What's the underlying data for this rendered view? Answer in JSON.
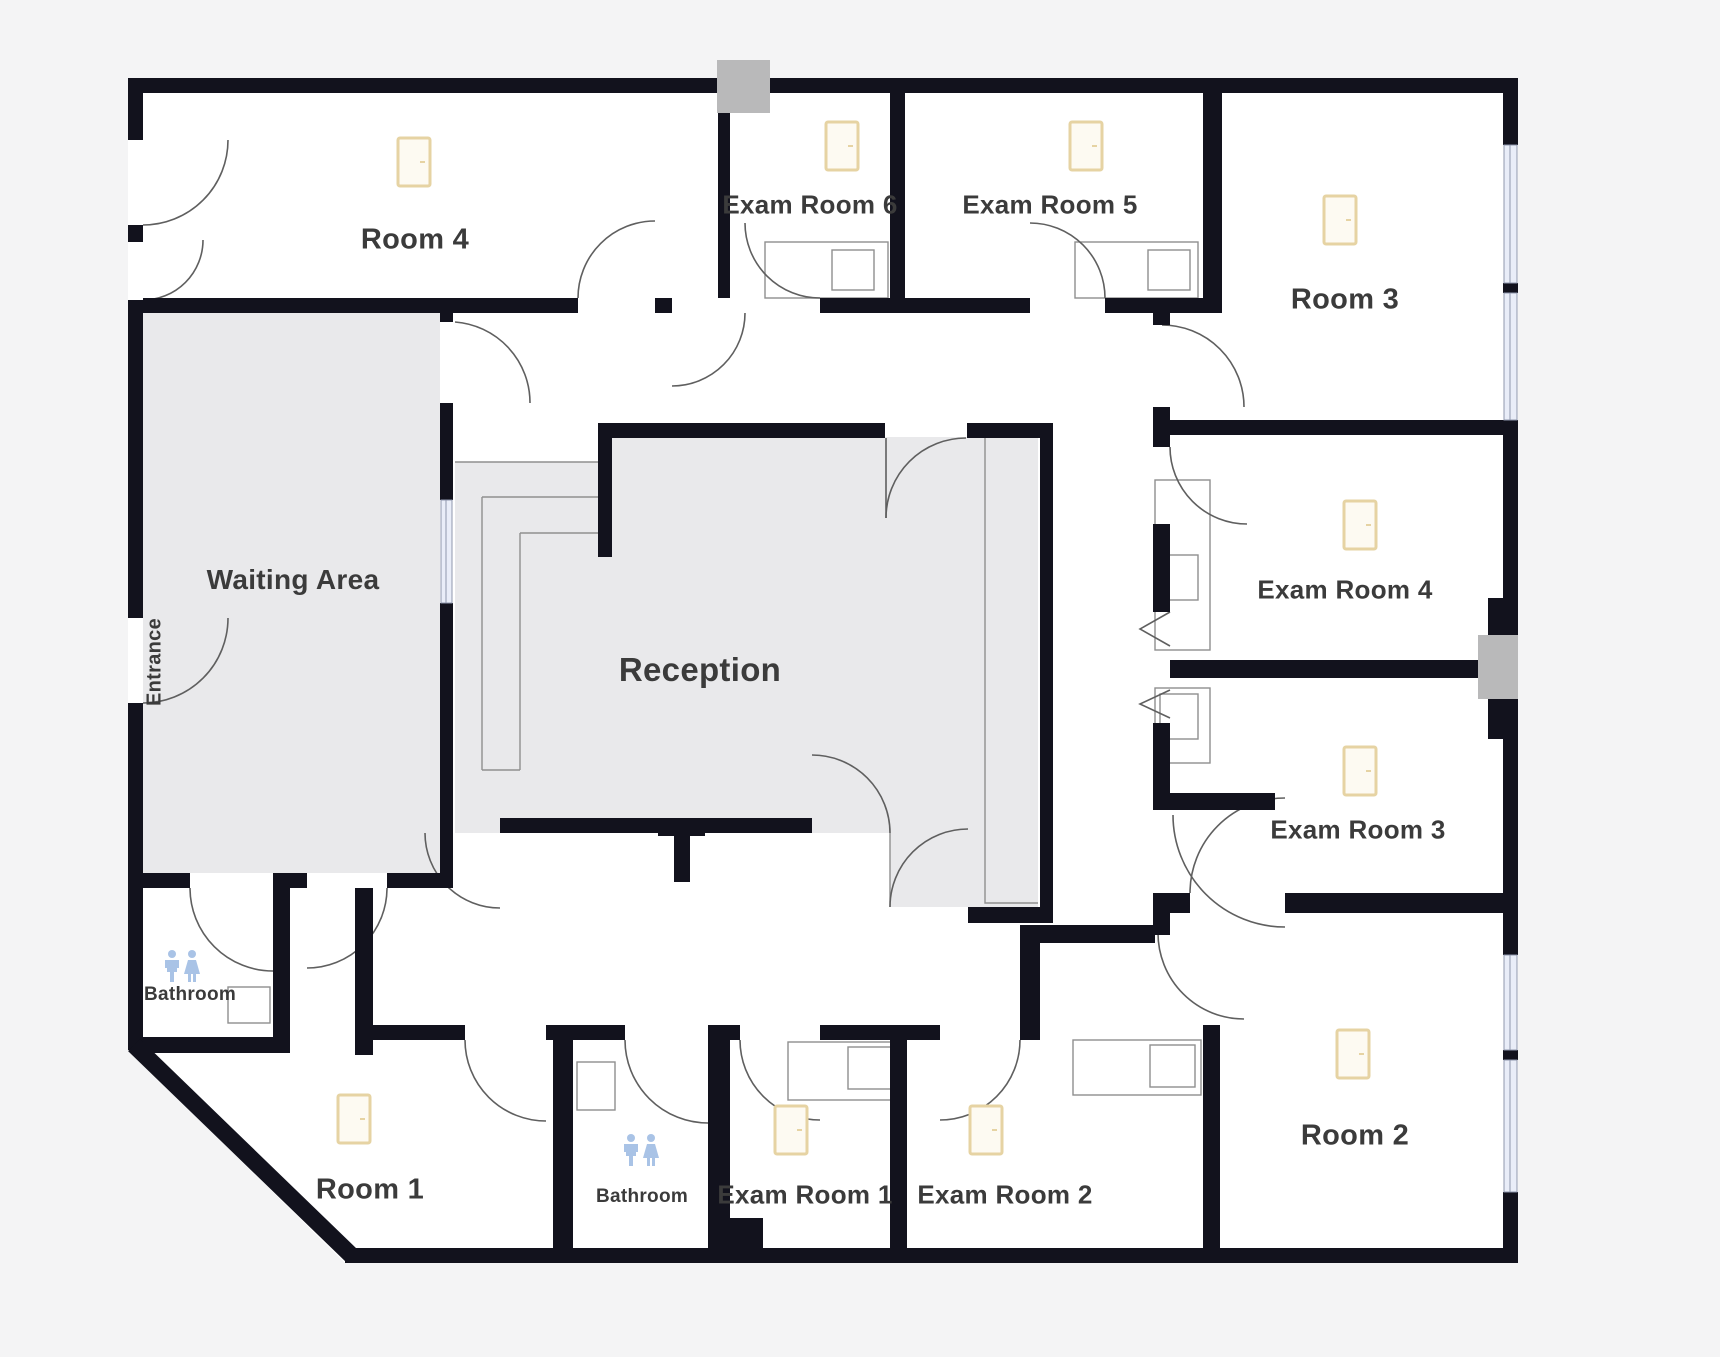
{
  "title": "Clinic floor plan",
  "rooms": {
    "room4": {
      "label": "Room 4"
    },
    "exam6": {
      "label": "Exam Room 6"
    },
    "exam5": {
      "label": "Exam Room 5"
    },
    "room3": {
      "label": "Room 3"
    },
    "waiting": {
      "label": "Waiting Area"
    },
    "reception": {
      "label": "Reception"
    },
    "exam4": {
      "label": "Exam Room 4"
    },
    "exam3": {
      "label": "Exam Room 3"
    },
    "room2": {
      "label": "Room 2"
    },
    "room1": {
      "label": "Room 1"
    },
    "bathroom_upper": {
      "label": "Bathroom"
    },
    "bathroom_lower": {
      "label": "Bathroom"
    },
    "exam1": {
      "label": "Exam Room 1"
    },
    "exam2": {
      "label": "Exam Room 2"
    },
    "entrance": {
      "label": "Entrance"
    }
  },
  "icons": {
    "door": "door-icon",
    "restroom": "restroom-icon",
    "window": "window-strip",
    "column": "structural-column",
    "door_swing": "door-swing-arc",
    "counter": "counter-with-sink"
  },
  "colors": {
    "wall": "#12121d",
    "room_fill": "#ffffff",
    "shaded_fill": "#e9e9eb",
    "outside": "#f4f4f5",
    "door_icon_stroke": "#e6d3a3",
    "door_icon_fill": "#fdfaf2",
    "window_fill": "#e9edf8",
    "restroom_icon": "#a9c3e6",
    "label_color": "#3b3b3b",
    "column_fill": "#b9b9ba"
  }
}
